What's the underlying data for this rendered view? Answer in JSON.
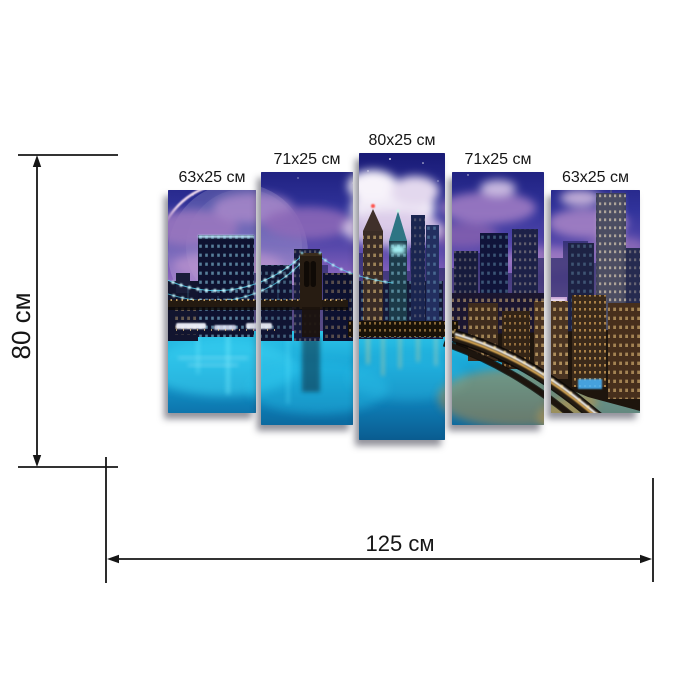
{
  "page": {
    "background": "#ffffff",
    "description": "Dimension diagram of a five-panel modular wall painting depicting a night city skyline with a suspension bridge, glowing moon, teal river and illuminated highway"
  },
  "dimensions": {
    "height_label": "80 см",
    "width_label": "125 см"
  },
  "artwork": {
    "origin": {
      "x": 168,
      "y": 153
    },
    "panels": [
      {
        "label": "63x25 см",
        "x": 168,
        "y": 190,
        "w": 88,
        "h": 223
      },
      {
        "label": "71x25 см",
        "x": 261,
        "y": 172,
        "w": 92,
        "h": 253
      },
      {
        "label": "80x25 см",
        "x": 359,
        "y": 153,
        "w": 86,
        "h": 287
      },
      {
        "label": "71x25 см",
        "x": 452,
        "y": 172,
        "w": 92,
        "h": 253
      },
      {
        "label": "63x25 см",
        "x": 551,
        "y": 190,
        "w": 89,
        "h": 223
      }
    ],
    "scene_palette": {
      "sky_top": "#181a75",
      "sky_purple": "#8a66bd",
      "sky_pink": "#cf9fd6",
      "cloud_white": "#f2ecf8",
      "moon_rim": "#ffe7f4",
      "cable_lights": "#c9f6ff",
      "window_gold": "#ffd78a",
      "window_cyan": "#9fe9ff",
      "water_teal": "#17a2d3",
      "reflection_gold": "#e8a73c",
      "annotation_line": "#161616"
    }
  }
}
